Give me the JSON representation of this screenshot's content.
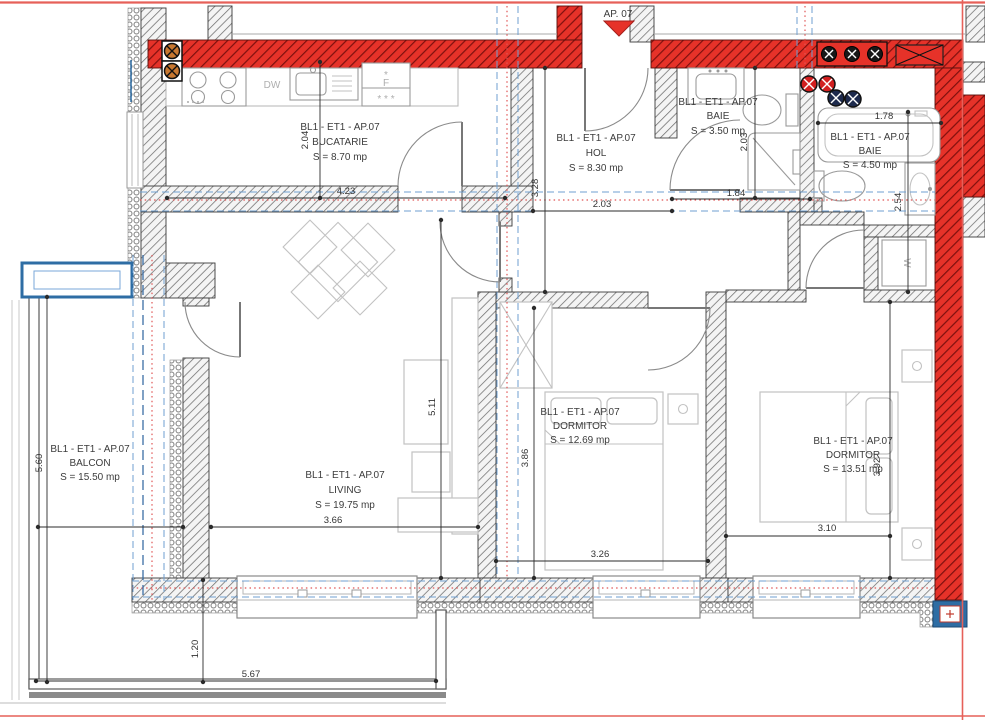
{
  "page": {
    "marker_label": "AP. 07"
  },
  "rooms": {
    "bucatarie": {
      "block": "BL1 - ET1 - AP.07",
      "name": "BUCATARIE",
      "area": "S = 8.70 mp"
    },
    "hol": {
      "block": "BL1 - ET1 - AP.07",
      "name": "HOL",
      "area": "S = 8.30 mp"
    },
    "baie_mica": {
      "block": "BL1 - ET1 - AP.07",
      "name": "BAIE",
      "area": "S = 3.50 mp"
    },
    "baie_mare": {
      "block": "BL1 - ET1 - AP.07",
      "name": "BAIE",
      "area": "S = 4.50 mp"
    },
    "balcon": {
      "block": "BL1 - ET1 - AP.07",
      "name": "BALCON",
      "area": "S = 15.50 mp"
    },
    "living": {
      "block": "BL1 - ET1 - AP.07",
      "name": "LIVING",
      "area": "S = 19.75 mp"
    },
    "dormitor1": {
      "block": "BL1 - ET1 - AP.07",
      "name": "DORMITOR",
      "area": "S = 12.69 mp"
    },
    "dormitor2": {
      "block": "BL1 - ET1 - AP.07",
      "name": "DORMITOR",
      "area": "S = 13.51 mp"
    }
  },
  "dims": {
    "bucatarie_w": "4.23",
    "bucatarie_h": "2.04",
    "hol_w": "2.03",
    "hol_h": "3.28",
    "baie_mica_w": "1.84",
    "baie_mica_h": "2.03",
    "baie_mare_w": "1.78",
    "baie_mare_h": "2.54",
    "balcon_w": "2.10",
    "balcon_h": "5.60",
    "living_w": "3.66",
    "living_h": "5.11",
    "dormitor1_w": "3.26",
    "dormitor1_h": "3.86",
    "dormitor2_w": "3.10",
    "dormitor2_h": "3.92",
    "balcon_jos_w": "5.67",
    "balcon_jos_h": "1.20"
  },
  "appliances": {
    "dishwasher": "DW",
    "fridge": "F",
    "fridge_star": "*",
    "fridge_stars": "* * *",
    "washing_machine": "W"
  },
  "colors": {
    "wall_red": "#e63229",
    "wall_red_hatch": "#7e100e",
    "accent_blue": "#2e6da4",
    "dashed_blue": "#6f9fd0",
    "dotted_red": "#e05555",
    "gas_orange": "#c87830",
    "riser_navy": "#1d2a4d",
    "riser_red": "#d21f1f"
  }
}
